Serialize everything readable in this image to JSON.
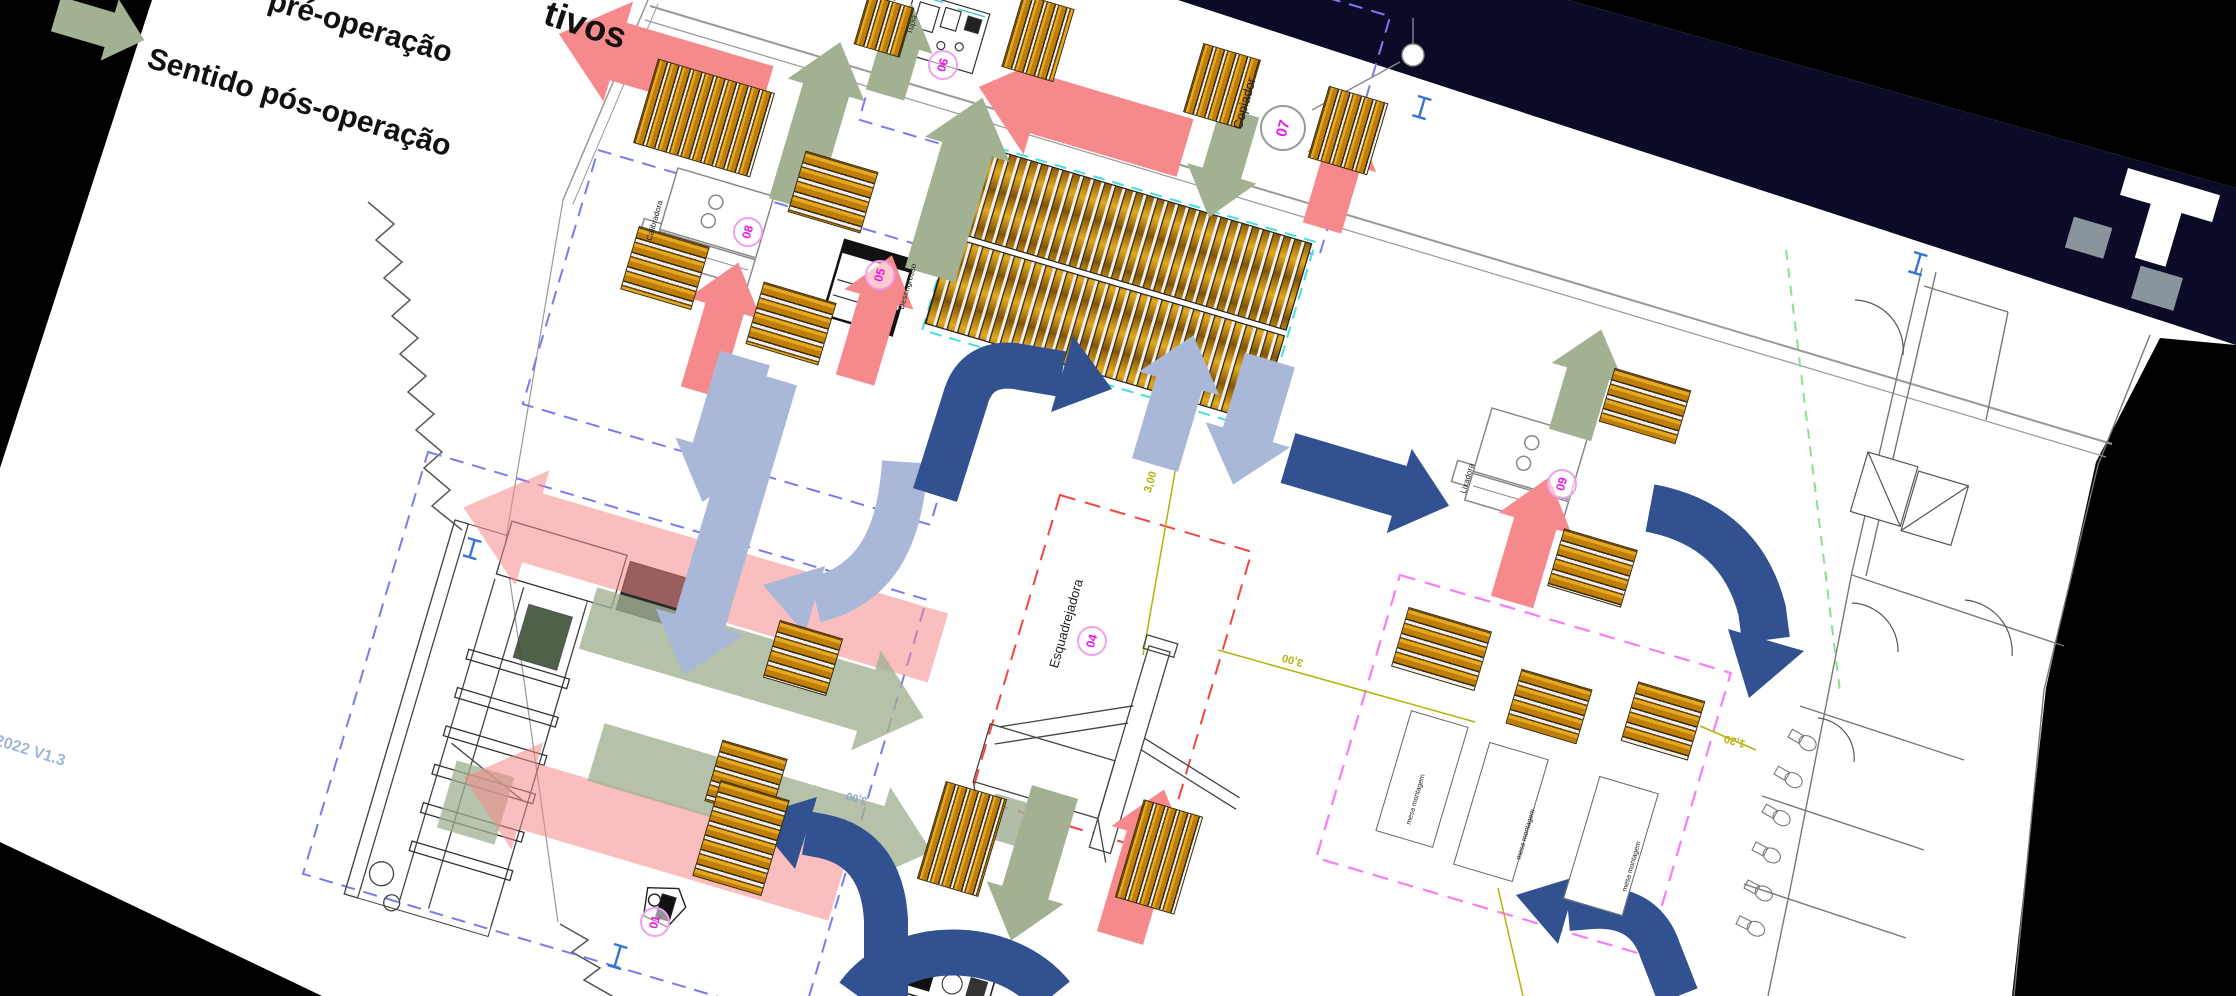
{
  "scene": {
    "legend": {
      "pre_operation_label": "pré-operação",
      "post_operation_label": "Sentido pós-operação"
    },
    "title_fragment": "tivos",
    "version_label": "5-2022 V1.3"
  },
  "machines": [
    {
      "number": "01",
      "name": ""
    },
    {
      "number": "04",
      "name": "Esquadrejadora"
    },
    {
      "number": "05",
      "name": "Desengrosso"
    },
    {
      "number": "06",
      "name": "Tupia"
    },
    {
      "number": "07",
      "name": "Copiador"
    },
    {
      "number": "08",
      "name": "Calibradora"
    },
    {
      "number": "09",
      "name": "Lixadora"
    }
  ],
  "assembly_tables": {
    "label": "mesa montagem"
  },
  "dimensions": [
    {
      "value": "3,00"
    },
    {
      "value": "3,00"
    },
    {
      "value": "3,00"
    },
    {
      "value": "1,20"
    }
  ],
  "colors": {
    "pre_arrow": "#F5898B",
    "post_arrow": "#A3B193",
    "flow_light": "#A9B8D8",
    "flow_dark": "#315190",
    "slide_band": "#0B0B28",
    "wood": "#D99C1C",
    "marker": "#E814E8",
    "dimension": "#B3B30A"
  }
}
